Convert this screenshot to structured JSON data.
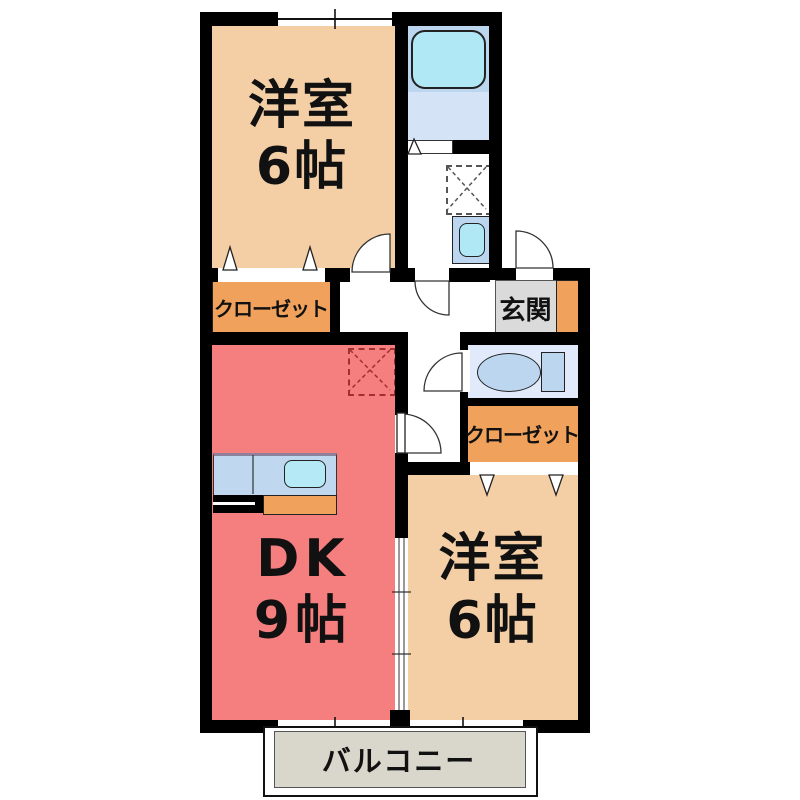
{
  "floorplan": {
    "rooms": {
      "bedroom_top": {
        "name": "洋室",
        "size": "6帖"
      },
      "dk": {
        "name": "DK",
        "size": "9帖"
      },
      "bedroom_bottom": {
        "name": "洋室",
        "size": "6帖"
      },
      "closet_top": {
        "label": "クローゼット"
      },
      "closet_right": {
        "label": "クローゼット"
      },
      "entrance": {
        "label": "玄関"
      },
      "balcony": {
        "label": "バルコニー"
      }
    },
    "fixtures": [
      "bathtub",
      "washing-machine-space",
      "vanity-sink",
      "toilet",
      "kitchen-counter",
      "kitchen-sink",
      "stove",
      "refrigerator-space"
    ],
    "colors": {
      "wall": "#000000",
      "bedroom_floor": "#F4CFA6",
      "dk_floor": "#F57E7E",
      "closet": "#F0A25C",
      "entrance_floor": "#DADADA",
      "balcony_floor": "#D9D6CC",
      "bath_panel": "#BCD6EF",
      "bath_floor": "#D4E4F6",
      "toilet_floor": "#E0EAFB",
      "fixture_blue": "#B0E8F6",
      "counter_blue": "#BFD8F0",
      "fridge_dash": "#A03030"
    }
  }
}
